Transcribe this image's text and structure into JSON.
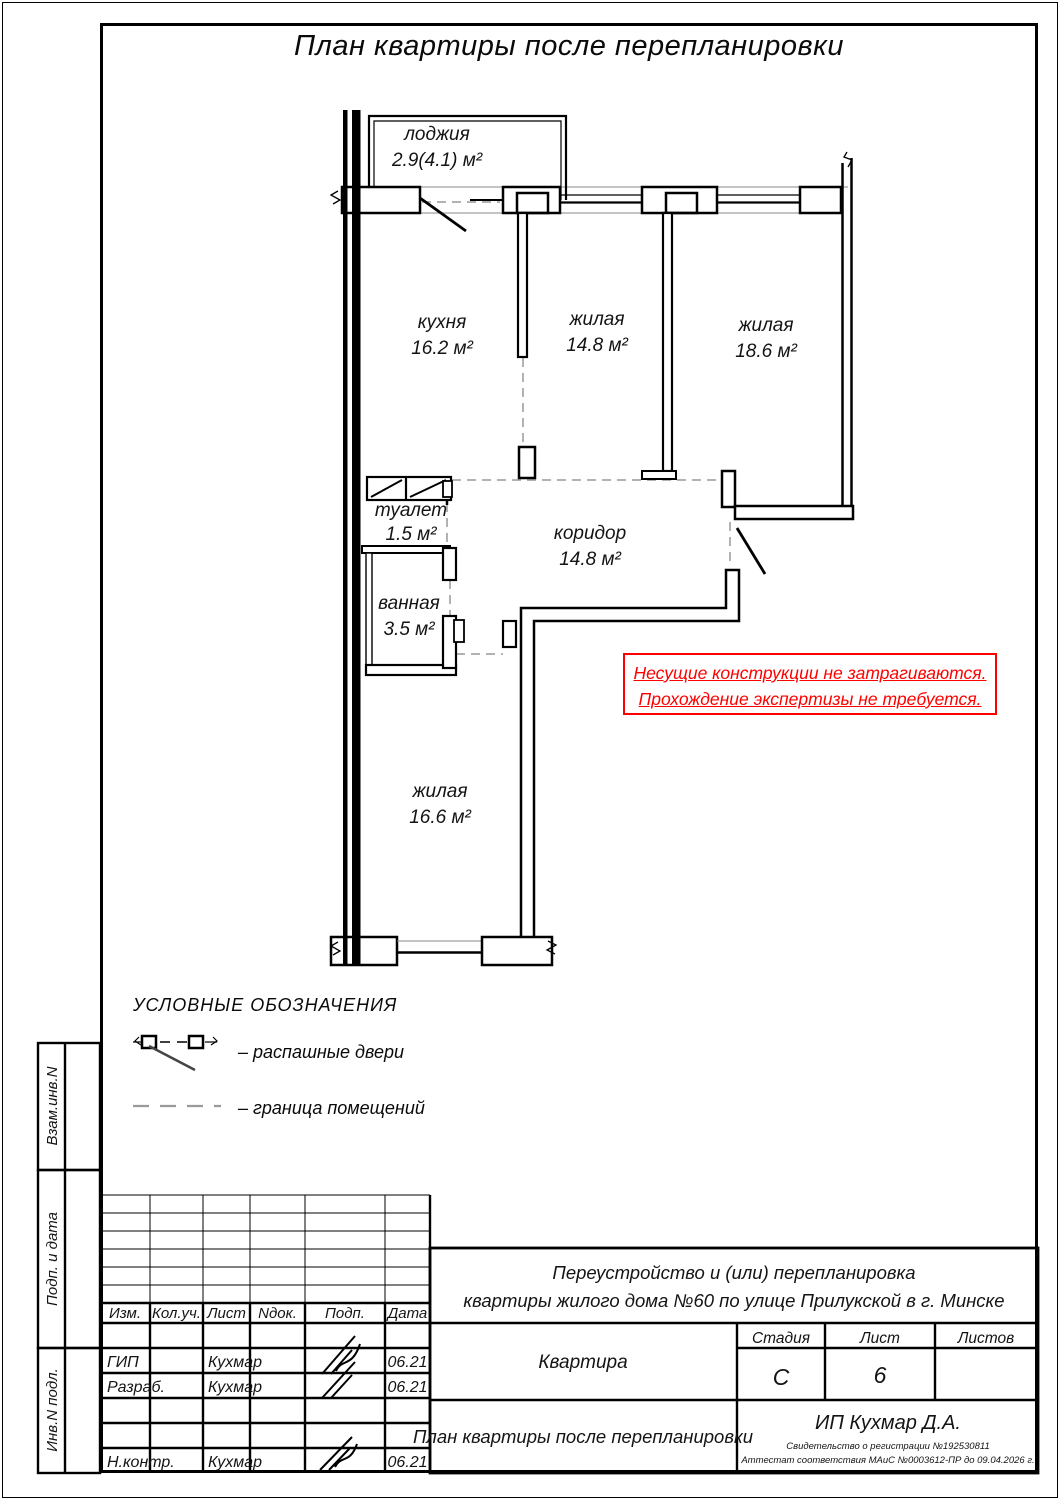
{
  "sheet": {
    "title": "План квартиры после перепланировки"
  },
  "colors": {
    "wall_line": "#000000",
    "boundary_dash": "#999999",
    "note_red": "#ff0000"
  },
  "plan": {
    "rooms": [
      {
        "name": "лоджия",
        "area": "2.9(4.1) м²"
      },
      {
        "name": "кухня",
        "area": "16.2 м²"
      },
      {
        "name": "жилая",
        "area": "14.8 м²"
      },
      {
        "name": "жилая",
        "area": "18.6 м²"
      },
      {
        "name": "туалет",
        "area": "1.5 м²"
      },
      {
        "name": "ванная",
        "area": "3.5 м²"
      },
      {
        "name": "коридор",
        "area": "14.8 м²"
      },
      {
        "name": "жилая",
        "area": "16.6 м²"
      }
    ],
    "note": {
      "line1": "Несущие конструкции не затрагиваются.",
      "line2": "Прохождение экспертизы не требуется."
    }
  },
  "legend": {
    "heading": "УСЛОВНЫЕ ОБОЗНАЧЕНИЯ",
    "items": [
      {
        "label": "–  распашные двери"
      },
      {
        "label": "–  граница помещений"
      }
    ]
  },
  "sidebar": {
    "cells": [
      "Взам.инв.N",
      "Подп. и дата",
      "Инв.N подл."
    ]
  },
  "titleblock": {
    "columns": [
      "Изм.",
      "Кол.уч.",
      "Лист",
      "Nдок.",
      "Подп.",
      "Дата"
    ],
    "rows": [
      {
        "role": "ГИП",
        "name": "Кухмар",
        "date": "06.21"
      },
      {
        "role": "Разраб.",
        "name": "Кухмар",
        "date": "06.21"
      },
      {
        "role": "Н.контр.",
        "name": "Кухмар",
        "date": "06.21"
      }
    ],
    "project_line1": "Переустройство и (или) перепланировка",
    "project_line2": "квартиры жилого дома №60 по улице Прилукской в г. Минске",
    "object": "Квартира",
    "stage_label": "Стадия",
    "sheet_label": "Лист",
    "sheets_label": "Листов",
    "stage": "С",
    "sheet_no": "6",
    "sheets": "",
    "doc_title": "План квартиры после перепланировки",
    "company": "ИП Кухмар Д.А.",
    "cert1": "Свидетельство о регистрации №192530811",
    "cert2": "Аттестат соответствия МАиС №0003612-ПР до 09.04.2026 г."
  }
}
